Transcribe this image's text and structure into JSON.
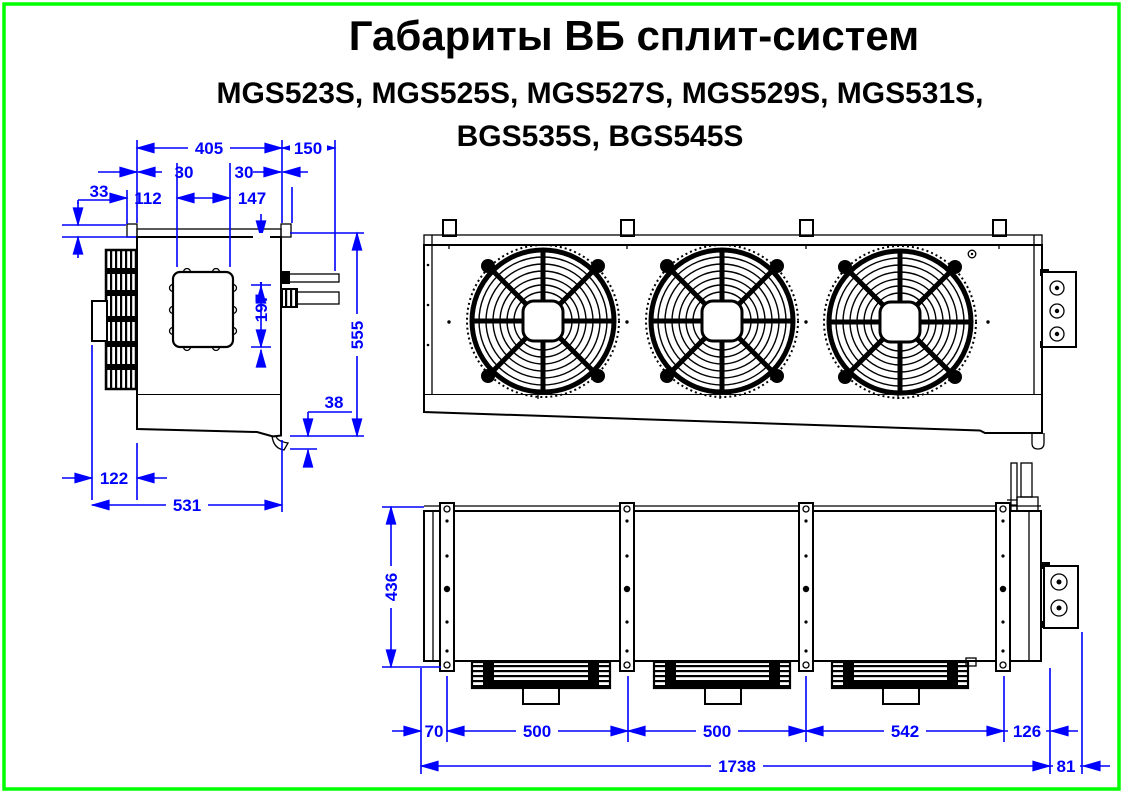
{
  "title": "Габариты ВБ сплит-систем",
  "subtitle_line1": "MGS523S, MGS525S, MGS527S, MGS529S, MGS531S,",
  "subtitle_line2": "BGS535S, BGS545S",
  "colors": {
    "border": "#00ff00",
    "drawing_lines": "#000000",
    "dimension_lines": "#0000ff"
  },
  "side_view": {
    "dims": {
      "top_width": "405",
      "pipe_extension": "150",
      "inset_left": "30",
      "inset_right": "30",
      "flange_height": "33",
      "left_section": "112",
      "mid_section": "147",
      "pipe1_offset": "105",
      "pipe2_offset": "197",
      "total_height": "555",
      "drain_drop": "38",
      "coil_offset": "122",
      "total_depth": "531"
    }
  },
  "plan_view": {
    "dims": {
      "depth": "436",
      "end_offset": "70",
      "fan_pitch_1": "500",
      "fan_pitch_2": "500",
      "fan_pitch_3": "542",
      "right_offset": "126",
      "total_length": "1738",
      "bracket_offset": "81"
    }
  }
}
